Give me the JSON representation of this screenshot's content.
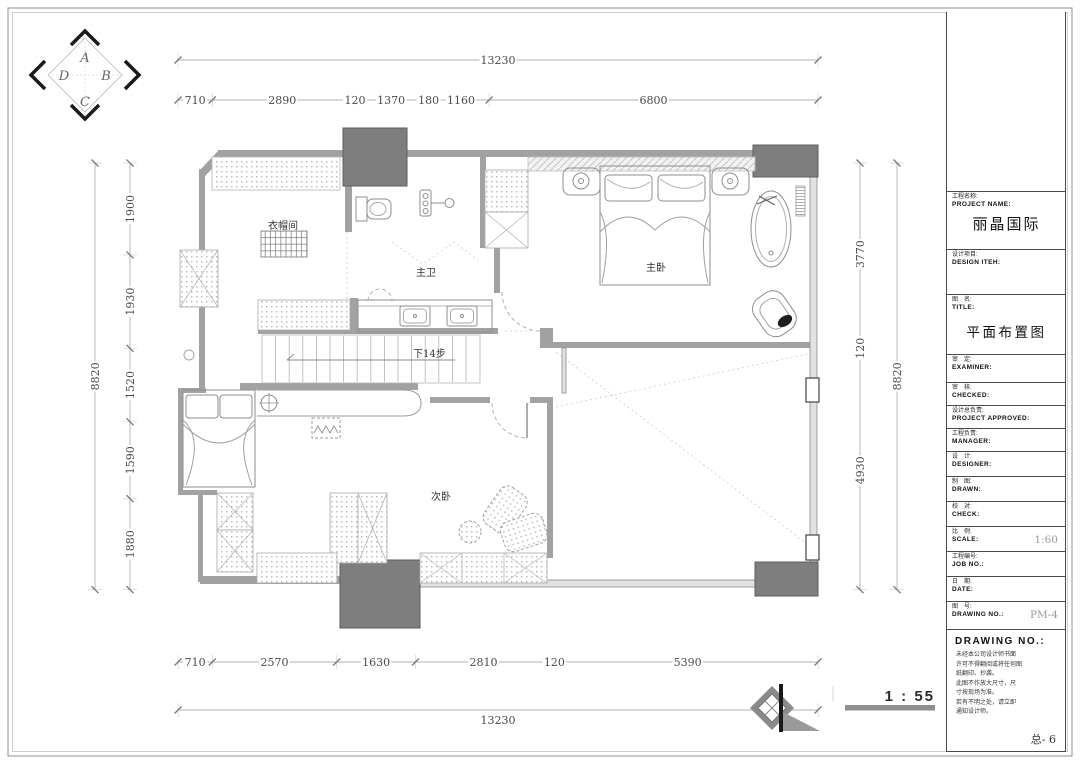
{
  "page": {
    "background": "#ffffff",
    "border_color": "#909090"
  },
  "compass": {
    "letters": {
      "top": "A",
      "right": "B",
      "bottom": "C",
      "left": "D"
    }
  },
  "plan": {
    "room_labels": {
      "cloakroom": "衣帽间",
      "master_bath": "主卫",
      "master_bedroom": "主卧",
      "second_bedroom": "次卧",
      "stair_note": "下14步"
    },
    "scale_note": "1 : 55",
    "wall_color": "#a2a2a2",
    "column_color": "#7e7e7e"
  },
  "dimensions": {
    "top": {
      "overall": "13230",
      "segments": [
        "710",
        "2890",
        "120",
        "1370",
        "180",
        "1160",
        "6800"
      ]
    },
    "bottom": {
      "overall": "13230",
      "segments": [
        "710",
        "2570",
        "1630",
        "2810",
        "120",
        "5390"
      ]
    },
    "left": {
      "overall": "8820",
      "segments": [
        "1900",
        "1930",
        "1520",
        "1590",
        "1880"
      ]
    },
    "right": {
      "overall": "8820",
      "segments": [
        "3770",
        "120",
        "4930"
      ]
    }
  },
  "title_block": {
    "rows": [
      {
        "cn": "工程名称:",
        "en": "PROJECT NAME:",
        "value": "丽晶国际",
        "style": "name"
      },
      {
        "cn": "设计项目:",
        "en": "DESIGN ITEH:",
        "value": "",
        "style": ""
      },
      {
        "cn": "图　名:",
        "en": "TITLE:",
        "value": "平面布置图",
        "style": "title"
      },
      {
        "cn": "审　定:",
        "en": "EXAMINER:",
        "value": "",
        "style": ""
      },
      {
        "cn": "审　核:",
        "en": "CHECKED:",
        "value": "",
        "style": ""
      },
      {
        "cn": "设计总负责:",
        "en": "PROJECT APPROVED:",
        "value": "",
        "style": ""
      },
      {
        "cn": "工程负责:",
        "en": "MANAGER:",
        "value": "",
        "style": ""
      },
      {
        "cn": "设　计:",
        "en": "DESIGNER:",
        "value": "",
        "style": ""
      },
      {
        "cn": "制　图:",
        "en": "DRAWN:",
        "value": "",
        "style": ""
      },
      {
        "cn": "校　对:",
        "en": "CHECK:",
        "value": "",
        "style": ""
      },
      {
        "cn": "比　例:",
        "en": "SCALE:",
        "value": "1:60",
        "style": "hand"
      },
      {
        "cn": "工程编号:",
        "en": "JOB NO.:",
        "value": "",
        "style": ""
      },
      {
        "cn": "日　期:",
        "en": "DATE:",
        "value": "",
        "style": ""
      },
      {
        "cn": "图　号:",
        "en": "DRAWING NO.:",
        "value": "PM-4",
        "style": "hand"
      }
    ],
    "notes_header": "DRAWING NO.:",
    "notes_lines": [
      "未经本公司设计师书面",
      "许可不得翻阅或将任何图",
      "纸翻印、抄袭。",
      "此图不作放大尺寸，尺",
      "寸按现场为准。",
      "若有不明之处，请立即",
      "通知设计师。"
    ],
    "sheet_number": "总- 6"
  }
}
